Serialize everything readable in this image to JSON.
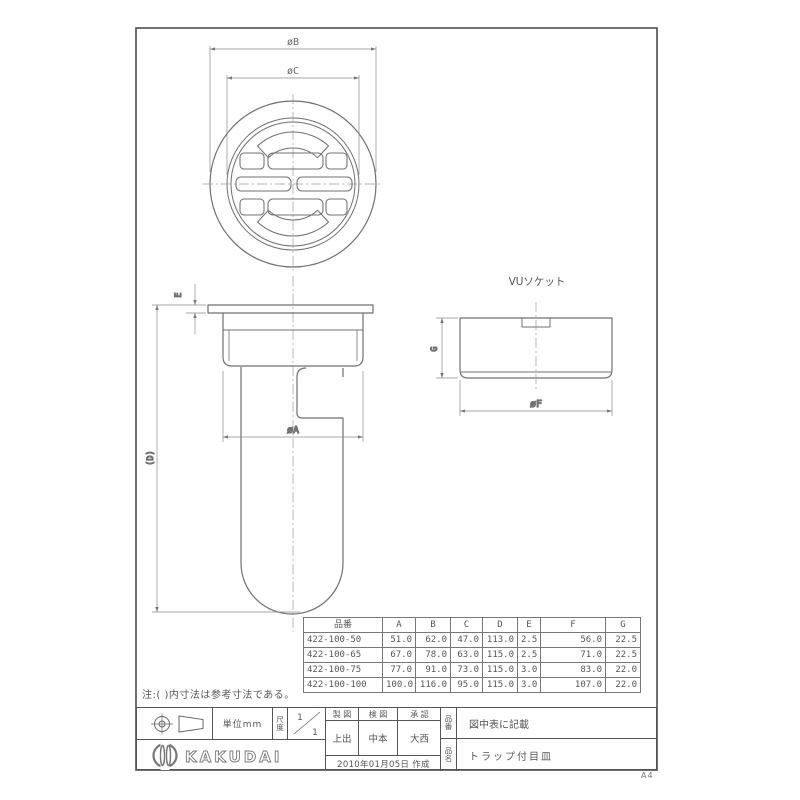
{
  "sheet": {
    "size_label": "A4"
  },
  "note": "注:( )内寸法は参考寸法である。",
  "views": {
    "top": {
      "dim_outer": "øB",
      "dim_inner": "øC"
    },
    "front": {
      "dim_flange_thickness": "E",
      "dim_height": "(D)",
      "dim_body": "øA"
    },
    "socket": {
      "title": "VUソケット",
      "dim_height": "G",
      "dim_outer": "øF"
    }
  },
  "spec_table": {
    "headers": [
      "品番",
      "A",
      "B",
      "C",
      "D",
      "E",
      "F",
      "G"
    ],
    "rows": [
      [
        "422-100-50",
        "51.0",
        "62.0",
        "47.0",
        "113.0",
        "2.5",
        "56.0",
        "22.5"
      ],
      [
        "422-100-65",
        "67.0",
        "78.0",
        "63.0",
        "115.0",
        "2.5",
        "71.0",
        "22.5"
      ],
      [
        "422-100-75",
        "77.0",
        "91.0",
        "73.0",
        "115.0",
        "3.0",
        "83.0",
        "22.0"
      ],
      [
        "422-100-100",
        "100.0",
        "116.0",
        "95.0",
        "115.0",
        "3.0",
        "107.0",
        "22.0"
      ]
    ]
  },
  "title_block": {
    "unit": "単位mm",
    "scale_label": "尺度",
    "scale_num": "1",
    "scale_den": "1",
    "columns": {
      "draft": "製 図",
      "check": "検 図",
      "approve": "承 認"
    },
    "staff": {
      "draft": "上出",
      "check": "中本",
      "approve": "大西"
    },
    "date": "2010年01月05日 作成",
    "part_no_label": "品番",
    "part_no": "図中表に記載",
    "part_name_label": "品名",
    "part_name": "トラップ付目皿",
    "brand": "KAKUDAI"
  }
}
